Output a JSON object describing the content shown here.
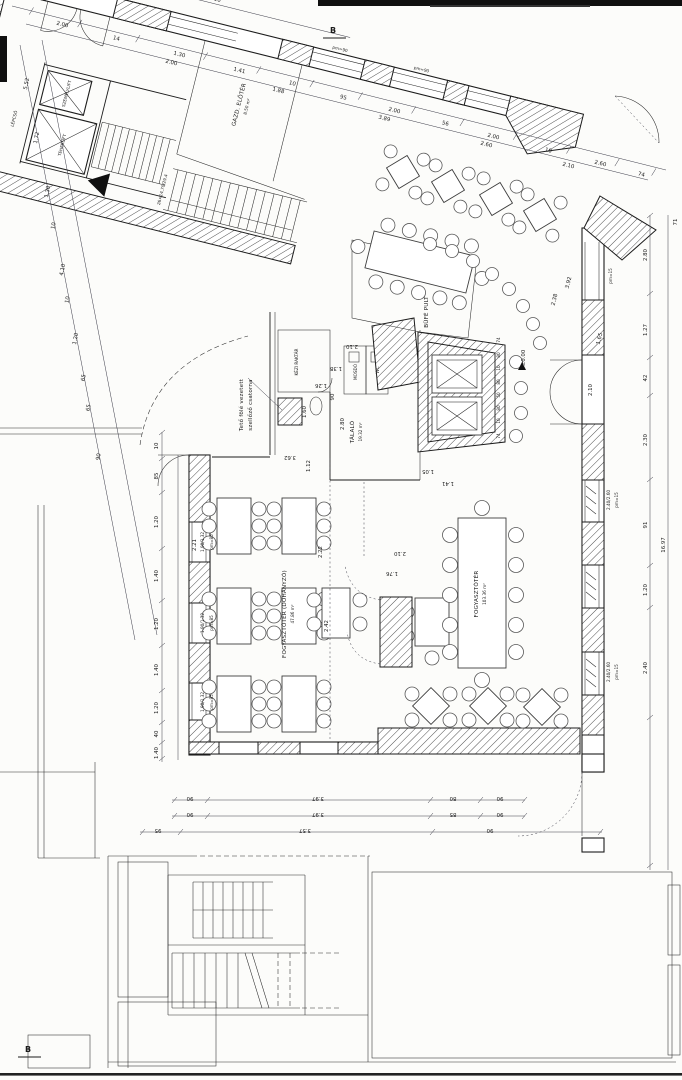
{
  "plan": {
    "markers": {
      "section": "B",
      "level": "±0.00"
    },
    "notes": {
      "vent1": "Tető fölé vezetett",
      "vent2": "szellőző csatorna",
      "stair": "26×14,70/29,4"
    },
    "rooms": {
      "dining_smoking": {
        "name": "FOGYASZTÓTÉR (DOHÁNYZÓ)",
        "area": "47.86 m²"
      },
      "dining_main": {
        "name": "FOGYASZTÓTÉR",
        "area": "103.36 m²"
      },
      "servery": {
        "name": "TÁLALÓ",
        "area": "19.32 m²"
      },
      "buffet": {
        "name": "BÜFÉ PULT"
      },
      "hand_store": {
        "name": "KÉZI RAKTÁR"
      },
      "vestibule": {
        "name": "GAZD. ELŐTÉR",
        "area": "8.50 m²"
      },
      "freight_lift": {
        "name": "TEHERLIFT"
      },
      "passenger_lift": {
        "name": "SZEMÉLYLIFT"
      },
      "stairs": {
        "name": "LÉPCSŐ"
      },
      "washroom": {
        "name": "MOSDÓ"
      },
      "wc": {
        "name": "WC"
      }
    },
    "windows": {
      "left_size": "1.90/1.32",
      "left_sill": "pm=85",
      "right_size": "2.40/2.60",
      "right_sill": "pm=15",
      "top_sill": "pm=90"
    },
    "dims": {
      "top_outer": [
        "2.00",
        "14",
        "1.30",
        "1.41",
        "10",
        "95",
        "2.00",
        "56",
        "2.00",
        "10",
        "2.60",
        "74"
      ],
      "top_inner": [
        "2.00",
        "1.88",
        "3.89",
        "2.60",
        "2.10"
      ],
      "top_short": [
        "1.20",
        "10",
        "1.41",
        "10"
      ],
      "left_outer": [
        "5.52",
        "1.72",
        "1.30",
        "10",
        "4.10",
        "10",
        "1.20",
        "65",
        "65",
        "90"
      ],
      "left_wall": [
        "10",
        "85",
        "1.20",
        "1.40",
        "1.20",
        "1.40",
        "1.20",
        "40",
        "1.40"
      ],
      "right_chain": [
        "2.80",
        "1.27",
        "42",
        "2.30",
        "91",
        "1.20",
        "2.40"
      ],
      "right_total": "16.97",
      "right_corner": "71",
      "bottom_row1": [
        "90",
        "3.97",
        "80",
        "90"
      ],
      "bottom_row2": [
        "90",
        "3.97",
        "85",
        "90"
      ],
      "bottom_row3": [
        "95",
        "3.57",
        "90"
      ],
      "counter": [
        "74",
        "80",
        "10",
        "80",
        "50",
        "80",
        "10",
        "74"
      ],
      "interior": [
        "2.22",
        "2.42",
        "1.76",
        "2.10",
        "2.80",
        "1.12",
        "1.60",
        "3.62",
        "1.26",
        "1.38",
        "2.10",
        "90",
        "2.10",
        "1.05",
        "1.41",
        "2.38",
        "3.92",
        "1.65",
        "2.21"
      ]
    }
  }
}
